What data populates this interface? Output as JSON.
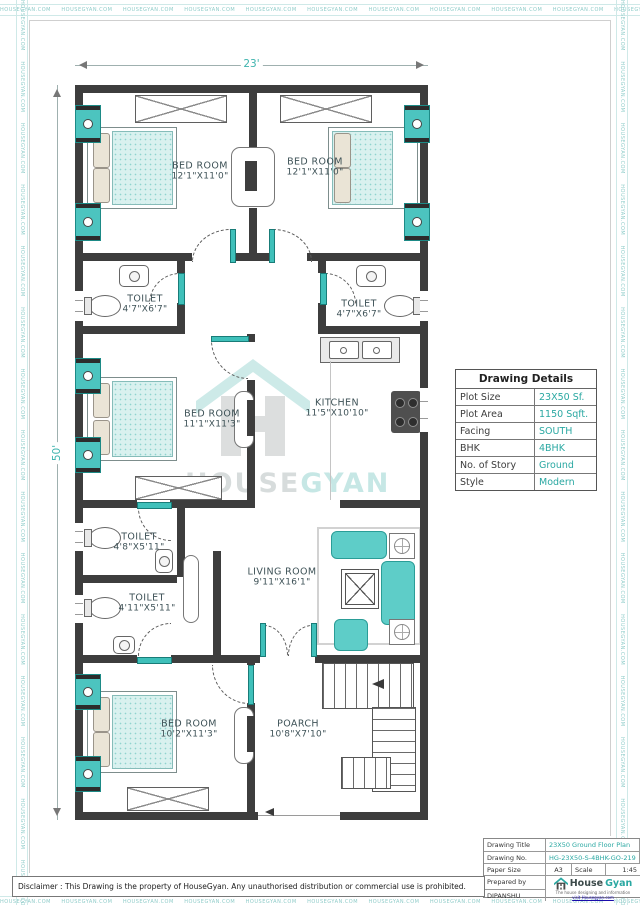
{
  "page": {
    "border_text": "HOUSEGYAN.COM",
    "disclaimer": "Disclaimer : This Drawing is the property of HouseGyan. Any unauthorised distribution or commercial use is prohibited."
  },
  "plan": {
    "dimensions": {
      "width": "23'",
      "height": "50'"
    },
    "rooms": [
      {
        "name": "BED ROOM",
        "size": "12'1\"X11'0\""
      },
      {
        "name": "BED ROOM",
        "size": "12'1\"X11'0\""
      },
      {
        "name": "TOILET",
        "size": "4'7\"X6'7\""
      },
      {
        "name": "TOILET",
        "size": "4'7\"X6'7\""
      },
      {
        "name": "BED ROOM",
        "size": "11'1\"X11'3\""
      },
      {
        "name": "KITCHEN",
        "size": "11'5\"X10'10\""
      },
      {
        "name": "TOILET",
        "size": "4'8\"X5'11\""
      },
      {
        "name": "TOILET",
        "size": "4'11\"X5'11\""
      },
      {
        "name": "LIVING ROOM",
        "size": "9'11\"X16'1\""
      },
      {
        "name": "BED ROOM",
        "size": "10'2\"X11'3\""
      },
      {
        "name": "POARCH",
        "size": "10'8\"X7'10\""
      }
    ]
  },
  "watermark": {
    "word1": "HOUSE",
    "word2": "GYAN"
  },
  "details_table": {
    "title": "Drawing Details",
    "rows": [
      {
        "label": "Plot Size",
        "value": "23X50 Sf."
      },
      {
        "label": "Plot Area",
        "value": "1150 Sqft."
      },
      {
        "label": "Facing",
        "value": "SOUTH"
      },
      {
        "label": "BHK",
        "value": "4BHK"
      },
      {
        "label": "No. of Story",
        "value": "Ground"
      },
      {
        "label": "Style",
        "value": "Modern"
      }
    ]
  },
  "title_block": {
    "drawing_title_label": "Drawing Title",
    "drawing_title": "23X50 Ground Floor Plan",
    "drawing_no_label": "Drawing No.",
    "drawing_no": "HG-23X50-S-4BHK-GO-219",
    "paper_size_label": "Paper Size",
    "paper_size": "A3",
    "scale_label": "Scale",
    "scale": "1:45",
    "prepared_by_label": "Prepared by",
    "prepared_by": "DIPANSHU",
    "brand_name_1": "House",
    "brand_name_2": "Gyan",
    "tagline": "The house designing and information",
    "link": "visit Housegyan.com"
  },
  "colors": {
    "accent": "#2aa8a2",
    "wall": "#3d3d3d",
    "teal_light": "#cdeae8",
    "window_teal": "#4cc4bf"
  }
}
